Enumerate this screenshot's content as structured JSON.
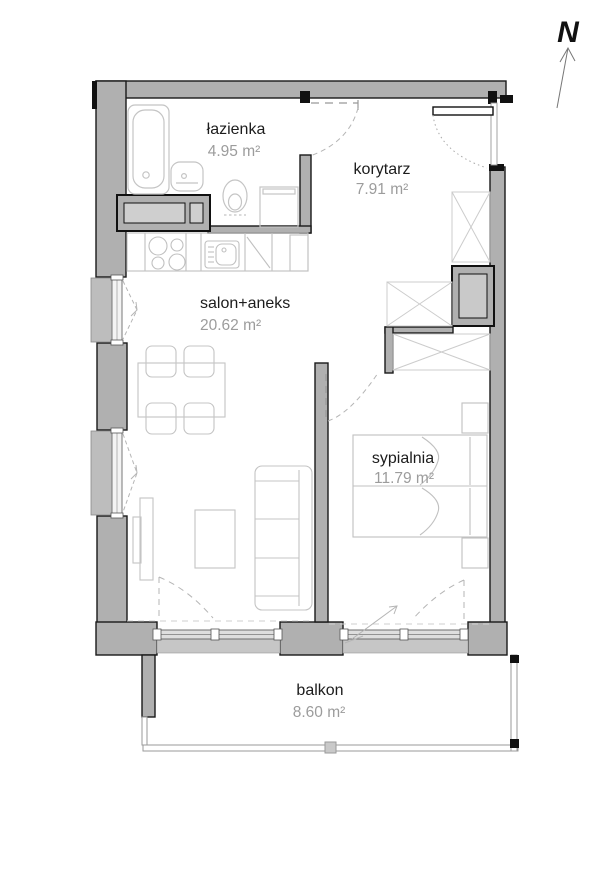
{
  "plan": {
    "compass": {
      "label": "N"
    },
    "rooms": [
      {
        "name": "łazienka",
        "area": "4.95 m²"
      },
      {
        "name": "korytarz",
        "area": "7.91 m²"
      },
      {
        "name": "salon+aneks",
        "area": "20.62 m²"
      },
      {
        "name": "sypialnia",
        "area": "11.79 m²"
      },
      {
        "name": "balkon",
        "area": "8.60 m²"
      }
    ],
    "colors": {
      "wall_fill": "#b0b0b0",
      "wall_line": "#1a1a1a",
      "furniture_line": "#c4c4c4",
      "area_text": "#9c9c9c",
      "swing_line": "#b5b5b5"
    }
  }
}
